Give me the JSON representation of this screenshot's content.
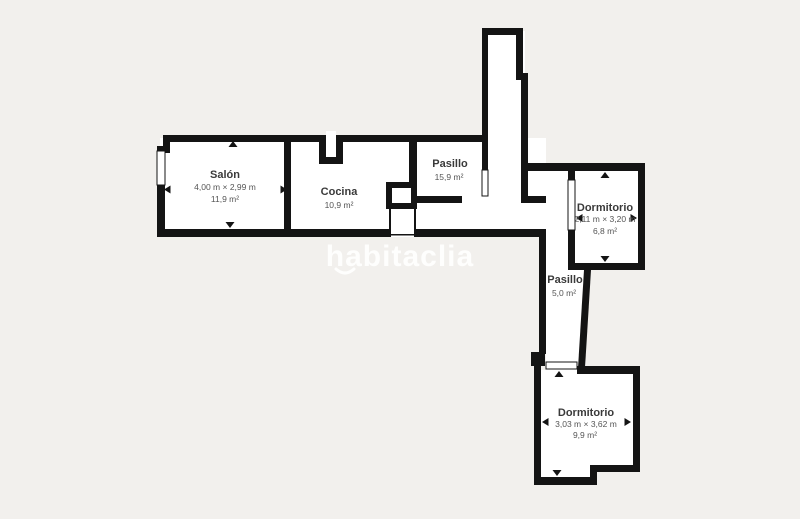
{
  "colors": {
    "background": "#f2f0ed",
    "wall": "#141414",
    "room_fill": "#ffffff",
    "label": "#3a3a3a",
    "sublabel": "#555555",
    "watermark": "rgba(255,255,255,0.88)"
  },
  "watermark": {
    "text": "habitaclia"
  },
  "rooms": [
    {
      "name": "Salón",
      "dimensions": "4,00 m × 2,99 m",
      "area": "11,9 m²"
    },
    {
      "name": "Cocina",
      "area": "10,9 m²"
    },
    {
      "name": "Pasillo",
      "area": "15,9 m²"
    },
    {
      "name": "Dormitorio",
      "dimensions": "2,11 m × 3,20 m",
      "area": "6,8 m²"
    },
    {
      "name": "Pasillo",
      "area": "5,0 m²"
    },
    {
      "name": "Dormitorio",
      "dimensions": "3,03 m × 3,62 m",
      "area": "9,9 m²"
    }
  ]
}
